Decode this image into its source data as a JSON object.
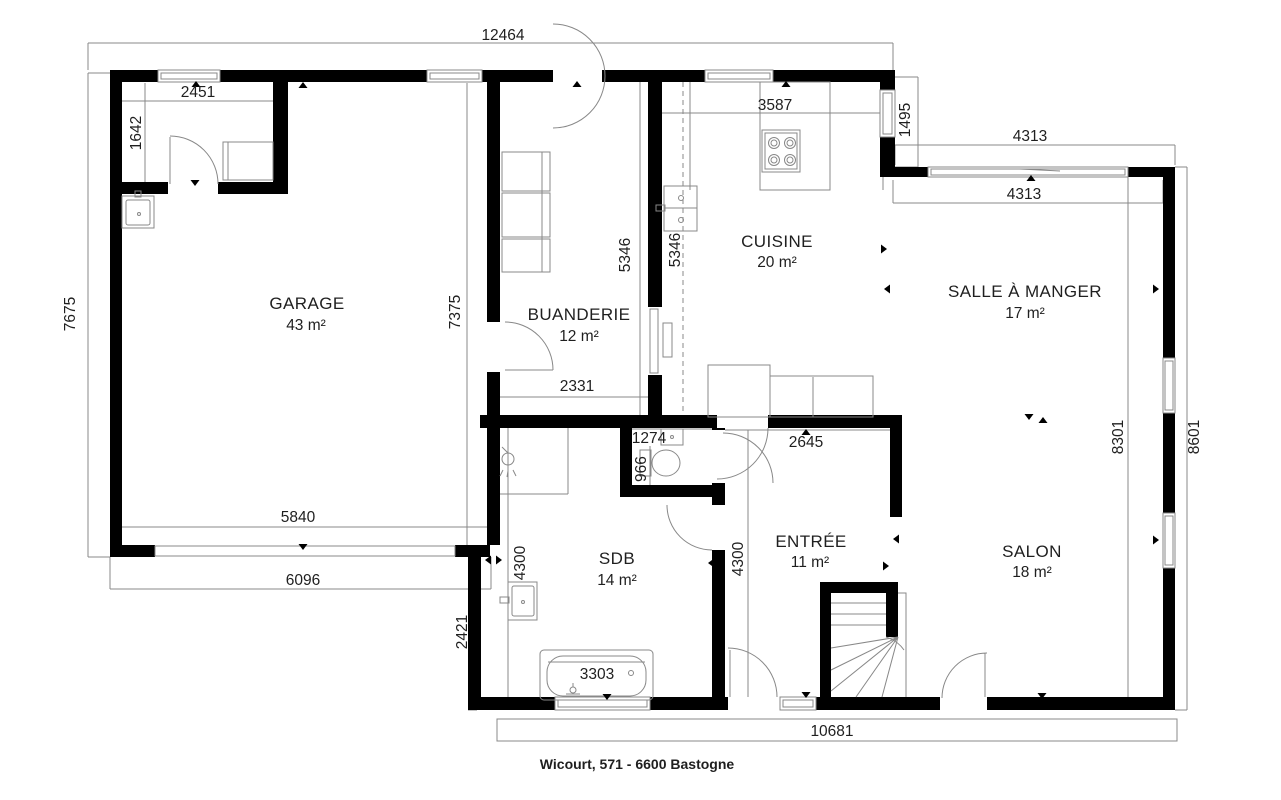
{
  "plan": {
    "caption": "Wicourt, 571 - 6600 Bastogne",
    "rooms": {
      "garage": {
        "name": "GARAGE",
        "area": "43 m²"
      },
      "laundry": {
        "name": "BUANDERIE",
        "area": "12 m²"
      },
      "kitchen": {
        "name": "CUISINE",
        "area": "20 m²"
      },
      "dining": {
        "name": "SALLE À MANGER",
        "area": "17 m²"
      },
      "living": {
        "name": "SALON",
        "area": "18 m²"
      },
      "hall": {
        "name": "ENTRÉE",
        "area": "11 m²"
      },
      "bath": {
        "name": "SDB",
        "area": "14 m²"
      }
    },
    "dims": {
      "top_outer_width": "12464",
      "storage_width": "2451",
      "storage_height": "1642",
      "kitchen_top": "3587",
      "kitchen_right": "1495",
      "dining_top_outer": "4313",
      "dining_top_inner": "4313",
      "garage_left_outer": "7675",
      "garage_right_inner": "7375",
      "laundry_height": "5346",
      "kitchen_height": "5346",
      "laundry_width": "2331",
      "wc_width": "1274",
      "wc_height": "966",
      "hall_top": "2645",
      "right_inner_height": "8301",
      "right_outer_height": "8601",
      "garage_bottom_inner": "5840",
      "garage_bottom_outer": "6096",
      "bath_height": "4300",
      "hall_height": "4300",
      "left_step": "2421",
      "bathtub_width": "3303",
      "bottom_outer_width": "10681"
    },
    "icons": {
      "stove": "stove-icon",
      "sink": "sink-icon",
      "toilet": "toilet-icon",
      "bathtub": "bathtub-icon",
      "shower": "shower-icon",
      "stairs": "stairs-icon"
    },
    "colors": {
      "wall": "#000000",
      "line": "#888888",
      "text": "#1f1f1f",
      "background": "#ffffff"
    }
  }
}
